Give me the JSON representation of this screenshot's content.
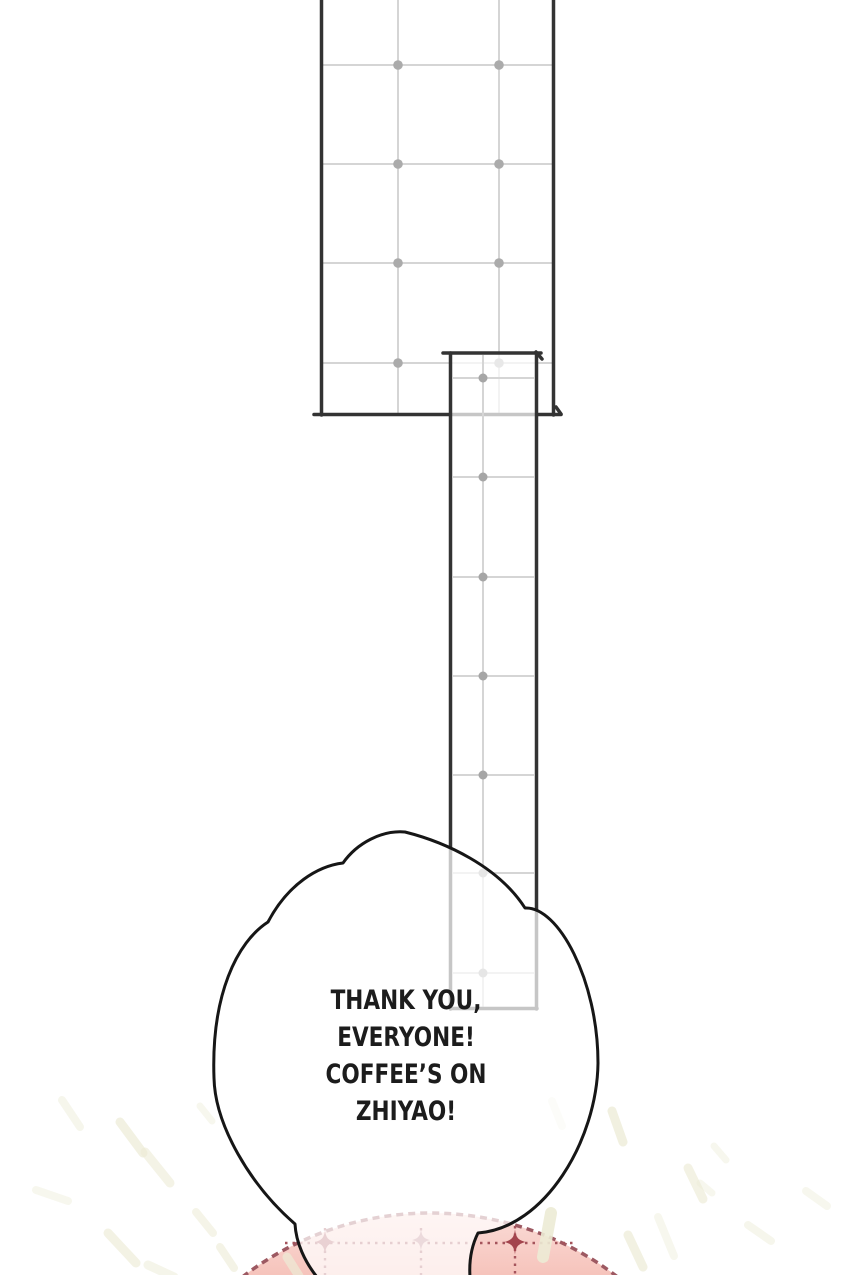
{
  "page": {
    "kind": "comic-panel"
  },
  "speech_bubble": {
    "lines": [
      "THANK YOU,",
      "EVERYONE!",
      "COFFEE’S ON",
      "ZHIYAO!"
    ]
  },
  "colors": {
    "background": "#ffffff",
    "ink_border": "#333333",
    "grid_line": "#d5d5d5",
    "grid_dot": "#ababab",
    "bubble_outline": "#161616",
    "dome_pink_light": "#fadfdb",
    "dome_pink": "#f6c3bb",
    "dome_edge_dashed": "#9d5962",
    "seam_dotted": "#a5545c",
    "star_red": "#a3444d",
    "star_pink": "#b05a63",
    "star_pale": "#bb7a80",
    "ray_cream": "#ecebd5"
  }
}
